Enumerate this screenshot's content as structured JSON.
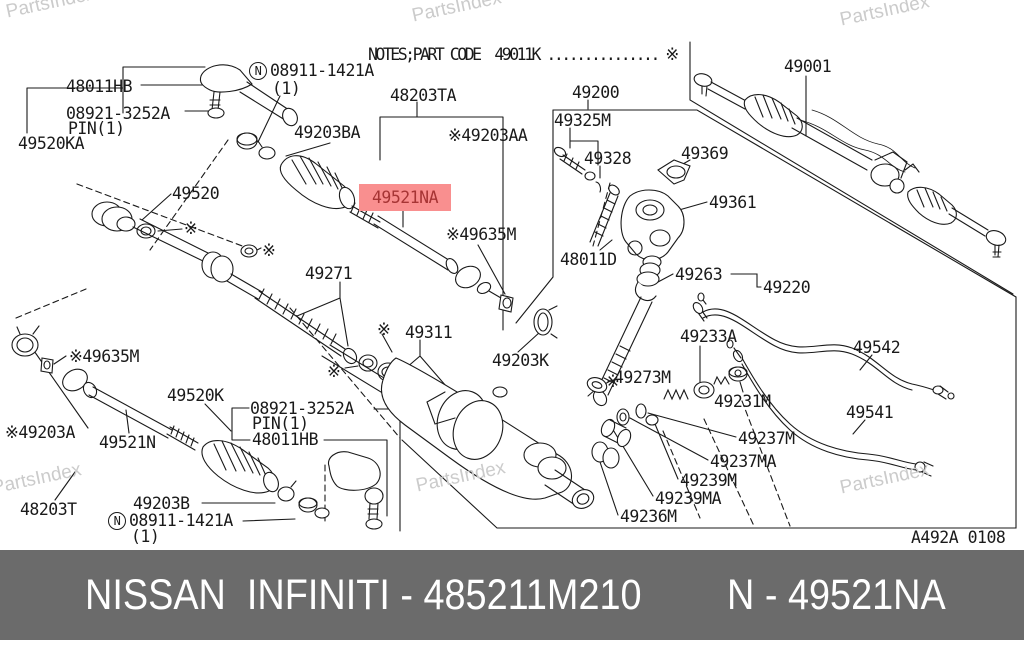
{
  "notes_line": "NOTES;PART CODE  49011K ............... ※",
  "watermark": "PartsIndex",
  "diagram_ref": "A492A 0108",
  "highlight": {
    "text": "49521NA",
    "bg": "#f98f8f",
    "color": "#a63434"
  },
  "footer": {
    "brand": "NISSAN  INFINITI - 485211M210",
    "part": "N - 49521NA",
    "bg": "#6b6b6b",
    "color": "#ffffff"
  },
  "colors": {
    "line": "#1a1a1a",
    "watermark": "#cbcbcb"
  },
  "labels": [
    {
      "text": "48011HB"
    },
    {
      "text": "08921-3252A"
    },
    {
      "text": "PIN(1)"
    },
    {
      "text": "49520KA"
    },
    {
      "prefix": "N",
      "text": "08911-1421A"
    },
    {
      "text": "(1)"
    },
    {
      "text": "49203BA"
    },
    {
      "text": "48203TA"
    },
    {
      "text": "※49203AA"
    },
    {
      "text": "49200"
    },
    {
      "text": "49325M"
    },
    {
      "text": "49328"
    },
    {
      "text": "49369"
    },
    {
      "text": "49001"
    },
    {
      "text": "49361"
    },
    {
      "text": "49520"
    },
    {
      "text": "※49635M"
    },
    {
      "text": "48011D"
    },
    {
      "text": "49271"
    },
    {
      "text": "49263"
    },
    {
      "text": "49220"
    },
    {
      "text": "49233A"
    },
    {
      "text": "49311"
    },
    {
      "text": "49203K"
    },
    {
      "text": "49273M"
    },
    {
      "text": "49231M"
    },
    {
      "text": "49542"
    },
    {
      "text": "49541"
    },
    {
      "text": "※49635M"
    },
    {
      "text": "※49203A"
    },
    {
      "text": "49521N"
    },
    {
      "text": "49520K"
    },
    {
      "text": "08921-3252A"
    },
    {
      "text": "PIN(1)"
    },
    {
      "text": "48011HB"
    },
    {
      "text": "49237M"
    },
    {
      "text": "49237MA"
    },
    {
      "text": "49239M"
    },
    {
      "text": "49239MA"
    },
    {
      "text": "49236M"
    },
    {
      "text": "49203B"
    },
    {
      "text": "48203T"
    },
    {
      "prefix": "N",
      "text": "08911-1421A"
    },
    {
      "text": "(1)"
    },
    {
      "text": "A492A 0108"
    },
    {
      "text": "※"
    },
    {
      "text": "※"
    },
    {
      "text": "※"
    },
    {
      "text": "※"
    },
    {
      "text": "※"
    }
  ]
}
